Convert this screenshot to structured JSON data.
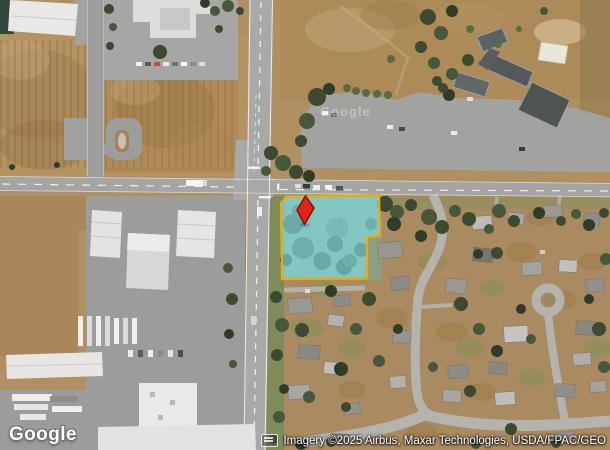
{
  "map": {
    "watermark_center": "Google",
    "logo": "Google",
    "attribution_text": "Imagery ©2025 Airbus, Maxar Technologies, USDA/FPAC/GEO"
  },
  "icons": {
    "keyboard_shortcuts": "keyboard"
  },
  "overlay": {
    "parcel": {
      "points": "286,197 379,195 380,236 367,237 367,278.5 282,279 281,203",
      "fill": "#7fd8e2",
      "fill_opacity": "0.68",
      "stroke": "#f4a70b",
      "stroke_width": "2.2"
    },
    "pin": {
      "points": "305.5,196 314,208 304.5,224.5 297,210",
      "fill": "#e02418",
      "stroke": "#8a120d",
      "stroke_width": "1.6"
    }
  }
}
